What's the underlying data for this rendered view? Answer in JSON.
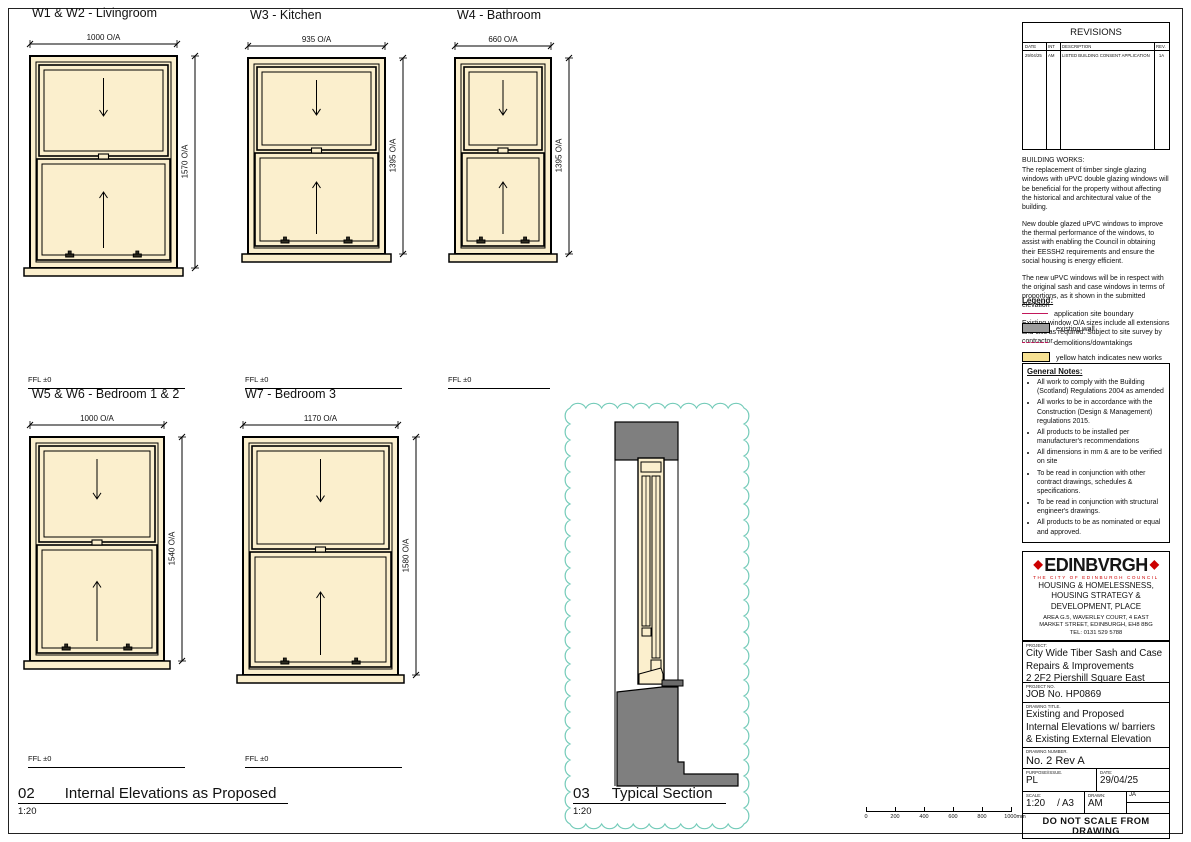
{
  "windows": [
    {
      "title": "W1 & W2 - Livingroom",
      "width_dim": "1000 O/A",
      "height_dim": "1570 O/A",
      "ffl": "FFL ±0"
    },
    {
      "title": "W3 - Kitchen",
      "width_dim": "935 O/A",
      "height_dim": "1395 O/A",
      "ffl": "FFL ±0"
    },
    {
      "title": "W4 - Bathroom",
      "width_dim": "660 O/A",
      "height_dim": "1395 O/A",
      "ffl": "FFL ±0"
    },
    {
      "title": "W5 & W6 - Bedroom 1 & 2",
      "width_dim": "1000 O/A",
      "height_dim": "1540 O/A",
      "ffl": "FFL ±0"
    },
    {
      "title": "W7 - Bedroom 3",
      "width_dim": "1170 O/A",
      "height_dim": "1580 O/A",
      "ffl": "FFL ±0"
    }
  ],
  "labels": {
    "elevations_number": "02",
    "elevations_title": "Internal Elevations as Proposed",
    "elevations_scale": "1:20",
    "section_number": "03",
    "section_title": "Typical Section",
    "section_scale": "1:20"
  },
  "scale_bar": {
    "ticks": [
      "0",
      "200",
      "400",
      "600",
      "800",
      "1000mm"
    ]
  },
  "revisions": {
    "title": "REVISIONS",
    "col_date": "DATE",
    "col_int": "INT",
    "col_description": "DESCRIPTION",
    "col_rev": "REV.",
    "rows": [
      {
        "date": "29/04/25",
        "int": "AM",
        "description": "LISTED BUILDING CONSENT APPLICATION",
        "rev": "1A"
      }
    ]
  },
  "building_works": {
    "title": "BUILDING WORKS:",
    "p1": "The replacement of timber single glazing windows with uPVC double glazing windows will be beneficial for the property without affecting the historical and architectural value of the building.",
    "p2": "New double glazed uPVC windows to improve the thermal performance of the windows, to assist with enabling the Council in obtaining their EESSH2 requirements and ensure the social housing is energy efficient.",
    "p3": "The new uPVC windows will be in respect with the original sash and case windows in terms of proportions, as it shown in the submitted elevation",
    "p4": "Existing window O/A sizes include all extensions and cills as required. Subject to site survey by contractor."
  },
  "legend": {
    "title": "Legend:",
    "items": [
      {
        "label": "application site boundary"
      },
      {
        "label": "existing wall"
      },
      {
        "label": "demolitions/downtakings"
      },
      {
        "label": "yellow hatch indicates new works"
      }
    ]
  },
  "general_notes": {
    "title": "General Notes:",
    "items": [
      "All work to comply with the Building (Scotland) Regulations 2004 as amended",
      "All works to be in accordance with the Construction (Design & Management) regulations 2015.",
      "All products to be installed per manufacturer's recommendations",
      "All dimensions in mm & are to be verified on site",
      "To be read in conjunction with other contract drawings, schedules & specifications.",
      "To be read in conjunction with structural engineer's drawings.",
      "All products to be as nominated or equal and approved."
    ]
  },
  "office": {
    "logo": "EDINBVRGH",
    "logo_subtitle": "THE CITY OF EDINBURGH COUNCIL",
    "dept_line1": "HOUSING & HOMELESSNESS,",
    "dept_line2": "HOUSING STRATEGY &",
    "dept_line3": "DEVELOPMENT, PLACE",
    "address_line1": "AREA G.5, WAVERLEY COURT, 4 EAST",
    "address_line2": "MARKET STREET, EDINBURGH, EH8 8BG",
    "tel": "TEL: 0131 529 5788"
  },
  "title_block": {
    "project_label": "PROJECT:",
    "project_line1": "City Wide Tiber Sash and Case",
    "project_line2": "Repairs & Improvements",
    "project_line3": "2 2F2 Piershill Square East",
    "project_no_label": "PROJECT No.",
    "project_no": "JOB No. HP0869",
    "drawing_title_label": "DRAWING TITLE.",
    "drawing_title_line1": "Existing and Proposed",
    "drawing_title_line2": "Internal Elevations w/ barriers",
    "drawing_title_line3": "& Existing External Elevation",
    "drawing_number_label": "DRAWING NUMBER.",
    "drawing_number": "No. 2 Rev A",
    "purpose_label": "PURPOSE/ISSUE.",
    "purpose": "PL",
    "date_label": "DATE:",
    "date": "29/04/25",
    "scale_label": "SCALE:",
    "scale": "1:20",
    "paper": "/ A3",
    "drawn_label": "DRAWN:",
    "drawn": "AM",
    "checked": "JA",
    "footer": "DO NOT SCALE FROM DRAWING"
  },
  "colors": {
    "new_works_fill": "#FBEFCD",
    "legend_yellow": "#F6E193",
    "existing_wall_gray": "#7F7F7F",
    "boundary_magenta": "#C2185B",
    "cloud_teal": "#74CBB9",
    "brand_red": "#CC0000"
  }
}
